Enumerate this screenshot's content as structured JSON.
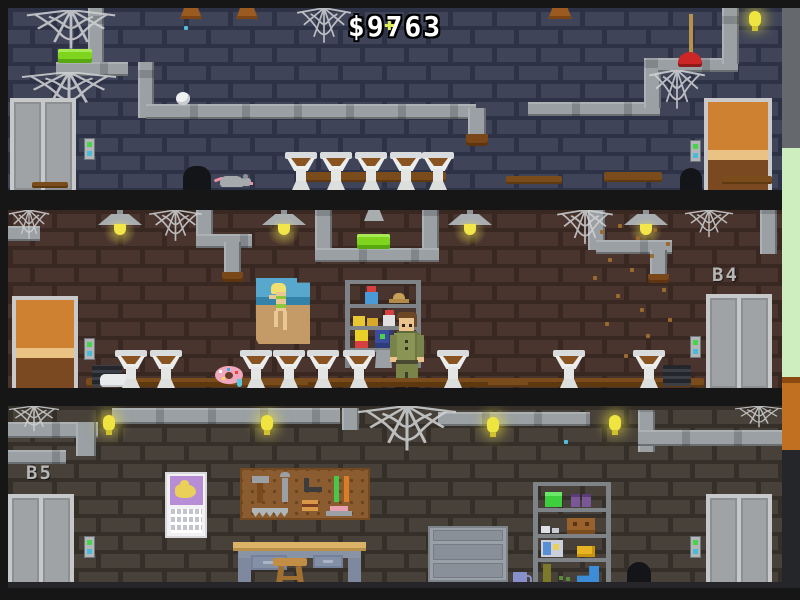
{
  "hud": {
    "money": "$9763"
  },
  "floors": [
    {
      "name": "basement-3",
      "label": ""
    },
    {
      "name": "basement-4",
      "label": "B4"
    },
    {
      "name": "basement-5",
      "label": "B5"
    }
  ],
  "palette": {
    "background": "#161616",
    "wall_b3_brick": "#3f4459",
    "wall_b3_mortar": "#2e3247",
    "wall_b4_brick": "#4a352e",
    "wall_b4_mortar": "#392721",
    "wall_b5_brick": "#48413a",
    "wall_b5_mortar": "#342f29",
    "pipe_gray": "#9aa0a3",
    "slime_green": "#7fd51e",
    "bulb_yellow": "#f0e440",
    "plunger_red": "#cc2626",
    "elevator_button_up": "#46d44a",
    "elevator_button_down": "#46bcd8",
    "door_wood_orange": "#cf8132",
    "dirt_brown": "#7a4c1c",
    "exterior_green": "#cfeec0",
    "exterior_orange": "#c07020",
    "money_text": "#ffffff",
    "floor_label_gray": "#b6b6b6"
  },
  "icons": {
    "money-counter": "dollar-amount",
    "spider-web-icon": "cobweb",
    "elevator-door": "double-sliding-door",
    "elevator-call-button": "green-cyan-two-dot-panel",
    "wooden-door": "orange-paneled-door",
    "urinal": "dirty-wall-urinal",
    "ceiling-lamp": "industrial-shade-lamp",
    "wall-bulb": "glowing-yellow-bulb",
    "plunger-icon": "red-plunger",
    "rat-icon": "gray-rat",
    "donut-icon": "pink-sprinkle-donut",
    "janitor": "man-in-green-uniform",
    "pinup-poster": "beach-pinup-poster",
    "calendar-icon": "wall-calendar",
    "pegboard": "tool-pegboard",
    "workbench": "workbench-with-stool",
    "tool-cabinet": "rolling-tool-cabinet",
    "storage-shelf": "metal-shelf-unit"
  }
}
